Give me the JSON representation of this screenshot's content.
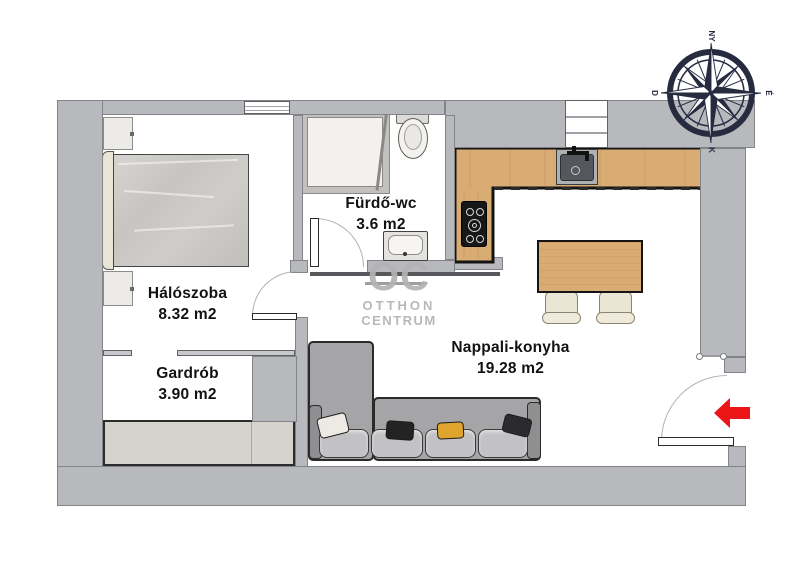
{
  "floorplan": {
    "rooms": [
      {
        "id": "bedroom",
        "name": "Hálószoba",
        "area": "8.32 m2"
      },
      {
        "id": "wardrobe",
        "name": "Gardrób",
        "area": "3.90 m2"
      },
      {
        "id": "bathroom",
        "name": "Fürdő-wc",
        "area": "3.6 m2"
      },
      {
        "id": "living-kitchen",
        "name": "Nappali-konyha",
        "area": "19.28 m2"
      }
    ],
    "compass": {
      "top": "NY",
      "right": "É",
      "bottom": "K",
      "left": "D"
    },
    "watermark": {
      "logo": "OC",
      "line1": "OTTHON",
      "line2": "CENTRUM"
    },
    "colors": {
      "wall_gray": "#b7b9bd",
      "wood": "#d9ac74",
      "entrance_arrow_red": "#ee1518",
      "compass_navy": "#262b40",
      "watermark_gray": "#b3b3b3",
      "sofa_gray": "#a5a5a7",
      "pillow_yellow": "#dfa42d"
    }
  }
}
